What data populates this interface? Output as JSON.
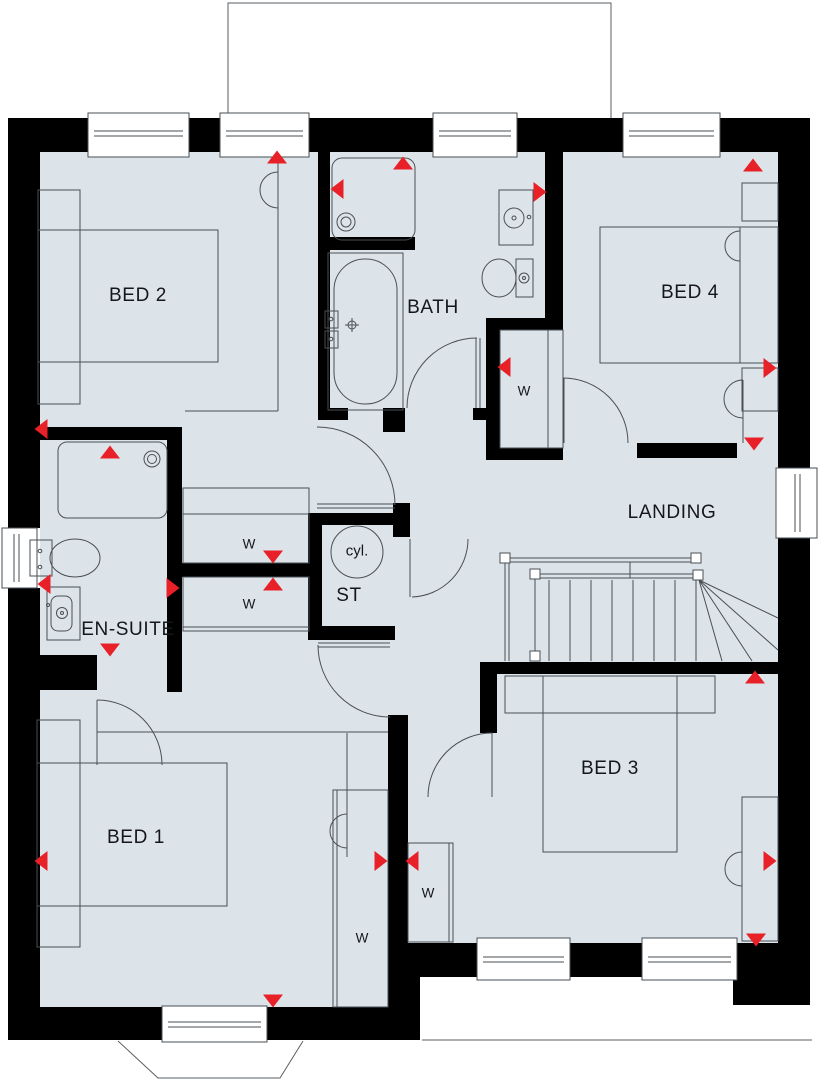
{
  "colors": {
    "floor_fill": "#dce4ea",
    "wall": "#000000",
    "furniture_line": "#4a4f54",
    "marker_red": "#e82128"
  },
  "rooms": {
    "bed1": "BED 1",
    "bed2": "BED 2",
    "bed3": "BED 3",
    "bed4": "BED 4",
    "bath": "BATH",
    "ensuite": "EN-SUITE",
    "storage": "ST",
    "landing": "LANDING"
  },
  "labels": {
    "wardrobe": "W",
    "cylinder": "cyl."
  },
  "markers": {
    "color": "#e82128",
    "items": [
      {
        "x": 277,
        "y": 157,
        "dir": "up"
      },
      {
        "x": 403,
        "y": 163,
        "dir": "up"
      },
      {
        "x": 337,
        "y": 189,
        "dir": "left"
      },
      {
        "x": 540,
        "y": 192,
        "dir": "right"
      },
      {
        "x": 753,
        "y": 165,
        "dir": "up"
      },
      {
        "x": 504,
        "y": 367,
        "dir": "left"
      },
      {
        "x": 770,
        "y": 368,
        "dir": "right"
      },
      {
        "x": 754,
        "y": 444,
        "dir": "down"
      },
      {
        "x": 41,
        "y": 429,
        "dir": "left"
      },
      {
        "x": 110,
        "y": 452,
        "dir": "up"
      },
      {
        "x": 273,
        "y": 557,
        "dir": "down"
      },
      {
        "x": 273,
        "y": 584,
        "dir": "up"
      },
      {
        "x": 44,
        "y": 584,
        "dir": "left"
      },
      {
        "x": 173,
        "y": 588,
        "dir": "right"
      },
      {
        "x": 110,
        "y": 650,
        "dir": "down"
      },
      {
        "x": 381,
        "y": 861,
        "dir": "right"
      },
      {
        "x": 412,
        "y": 861,
        "dir": "left"
      },
      {
        "x": 755,
        "y": 677,
        "dir": "up"
      },
      {
        "x": 770,
        "y": 861,
        "dir": "right"
      },
      {
        "x": 756,
        "y": 940,
        "dir": "down"
      },
      {
        "x": 273,
        "y": 1001,
        "dir": "down"
      },
      {
        "x": 41,
        "y": 861,
        "dir": "left"
      }
    ]
  }
}
